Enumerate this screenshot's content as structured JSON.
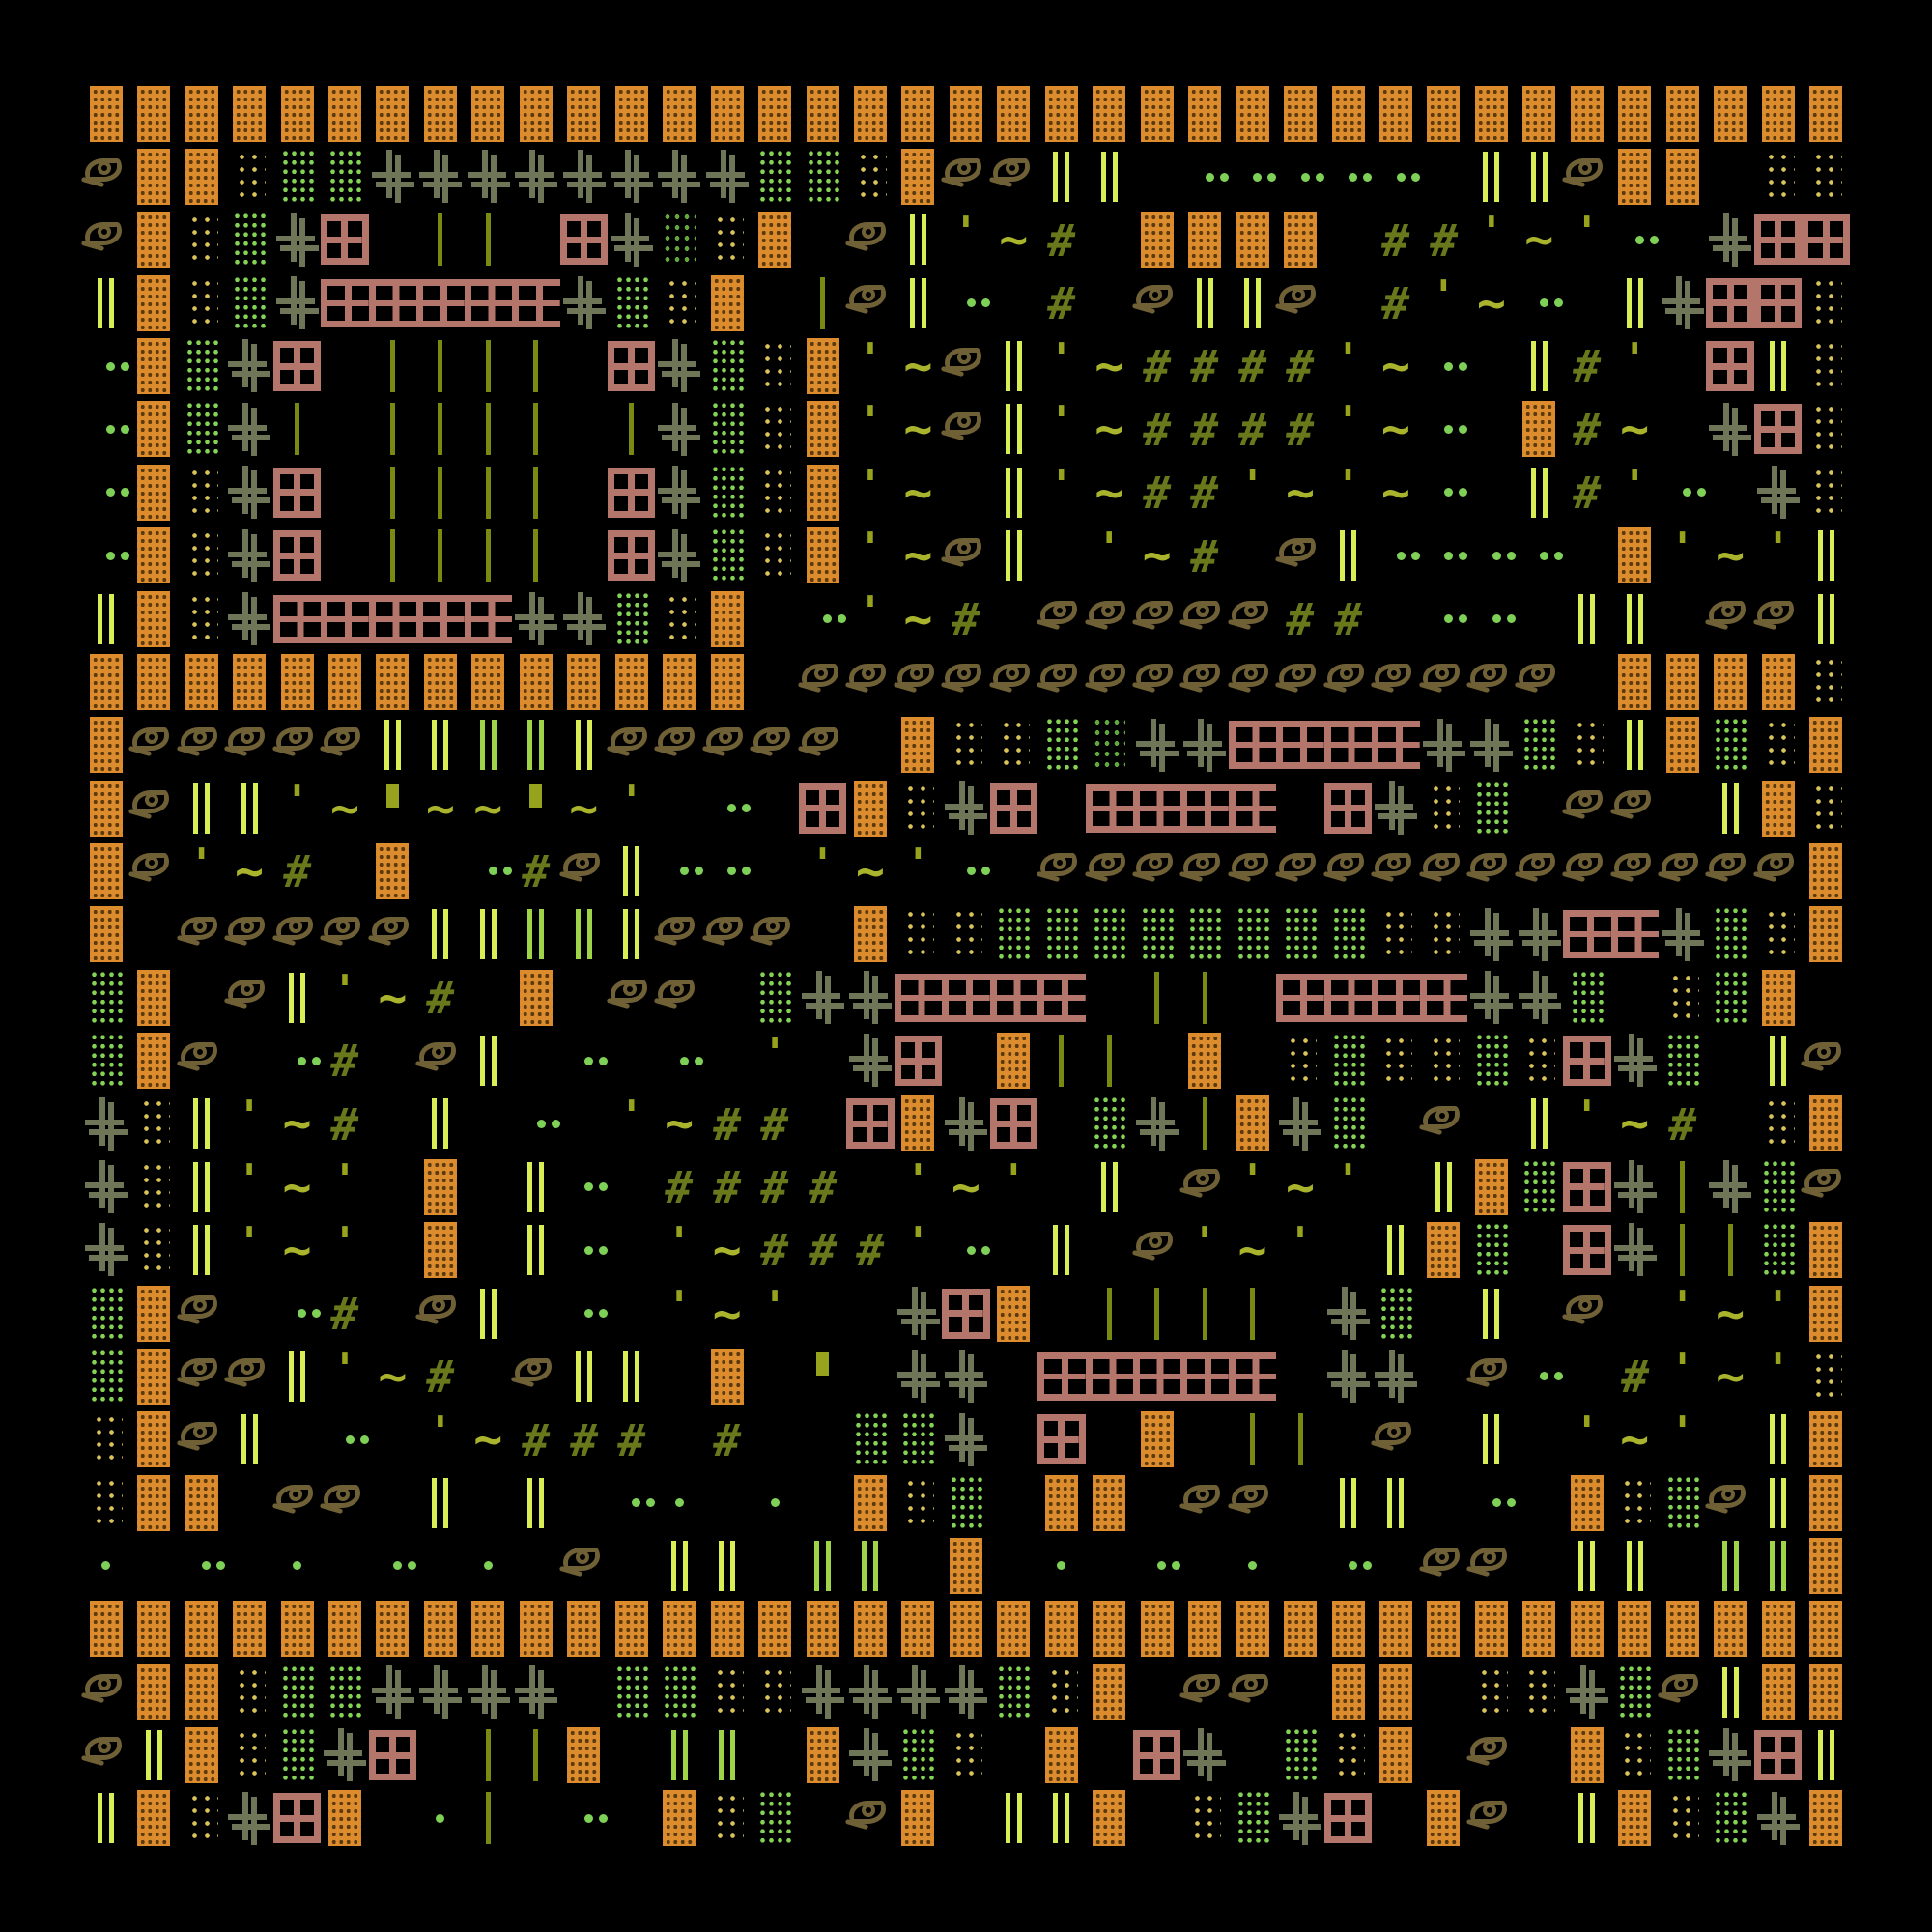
{
  "artwork_type": "textmode-glyph-mosaic",
  "palette": {
    "bg": "#000000",
    "orange": "#DC8B2D",
    "orangehole": "#5C3A0E",
    "salmon": "#B4756A",
    "green": "#85D355",
    "greendark": "#63A83F",
    "yellow": "#D9C257",
    "cross": "#6F7557",
    "chart": "#D9EE55",
    "midgreen": "#9FD348",
    "olive": "#7A8A10",
    "olive2": "#97A31C",
    "tilde": "#A9B42C",
    "hash": "#69781B",
    "eye": "#6F6036",
    "dotg": "#7FD057"
  },
  "grid": {
    "cols": 37,
    "rows": 28,
    "cell_w": 49.46,
    "cell_h": 65.36,
    "legend": {
      "O": "orange",
      "W": "pane",
      "S": "strip",
      "G": "green",
      "d": "greendark",
      "g": "greendark",
      "y": "yellow",
      "E": "eye",
      "+": "cross",
      "|": "barbright",
      "l": "bargreen",
      "i": "stem",
      "#": "hash",
      "~": "tilde",
      "'": "tick",
      "q": "quote",
      ".": "dots2",
      ",": "dot1",
      " ": "empty"
    },
    "glyphs": {
      "orange": {
        "name": "orange-dot-block"
      },
      "pane": {
        "name": "window-pane-icon"
      },
      "strip": {
        "name": "pane-strip-segment"
      },
      "green": {
        "name": "green-dot-block"
      },
      "greendark": {
        "name": "dark-green-dot-block"
      },
      "yellow": {
        "name": "yellow-dot-block"
      },
      "eye": {
        "name": "eye-icon",
        "parts": [
          "p-lid",
          "p-iris",
          "p-tail"
        ]
      },
      "cross": {
        "name": "double-cross-glyph"
      },
      "barbright": {
        "name": "double-bar-bright"
      },
      "bargreen": {
        "name": "double-bar-green"
      },
      "stem": {
        "name": "stem-bar"
      },
      "hash": {
        "name": "hash-glyph",
        "text": "#"
      },
      "tilde": {
        "name": "tilde-glyph",
        "text": "~"
      },
      "tick": {
        "name": "tick-glyph",
        "text": "'"
      },
      "quote": {
        "name": "quote-block"
      },
      "dots2": {
        "name": "dot-pair"
      },
      "dot1": {
        "name": "dot"
      },
      "empty": {
        "name": "empty-cell"
      }
    },
    "rows_data": [
      "OOOOOOOOOOOOOOOOOOOOOOOOOOOOOOOOOOOOO",
      "EOOyGG++++++++GGyOEE|| ..... ||EOO yy",
      "EOyG+W ii W+gyO E|'~# OOOO ##'~'. +WW",
      "|OyG+SSSSS+GyO iE|. # E||E #'~. |+WWy",
      ".OG+W iiii W+GyO'~E|'~####'~. |#' W|y",
      ".OG+i iiii i+GyO'~E|'~####'~. O#~ +Wy",
      ".Oy+W iiii W+GyO'~ |'~##'~'~. |#'. +y",
      ".Oy+W iiii W+GyO'~E| '~# E|.... O'~'|",
      "|Oy+SSSSS++GyO .'~# EEEEE## .. || EE|",
      "OOOOOOOOOOOOOO EEEEEEEEEEEEEEEE OOOOy",
      "OEEEEE||ll|EEEEE OyyGd++SSSS++Gy|OGyO",
      "OE||'~q~~q~' . WOy+W SSSS W+yG EE |Oy",
      "OE'~# O .#E|.. '~'. EEEEEEEEEEEEEEEEO",
      "O EEEEE||ll|EEE OyyGGGGGGGGyy++SS+GyO",
      "GO E|'~# O EE G++SSSS ii SSSS++G yGO",
      "GOE .# E| . . ' +W Oii O yGyyGyW+G |EO",
      "+y|'~# | . '~## WO+W G+iO+G E |'~# yO",
      "+y|'~' O |. #### '~' | E'~' |OGW+i+GE",
      "+y|'~' O |. '~###'. | E'~' |OG W+iiGO",
      "GOE .# E| . '~'  +WO iiii +G | E '~'O",
      "GOEE|'~# E|| O q ++ SSSSS ++ E. #'~'y",
      "yOE| . '~### #  GG+ W O ii E | '~' |O",
      "yOO EE | | ., , OyG OO EE || . OyGE|O",
      ", . , . , E || ll O , . , . EE || llO",
      "OOOOOOOOOOOOOOOOOOOOOOOOOOOOOOOOOOOOO",
      "EOOyGG++++ GGyy++++GyO EE OO yy+GE|OO",
      "E|OyG+W iiO ll O+Gy O W+ GyO E OyG+W|",
      "|Oy+WO ,i . OyG EO ||O yG+W OE |OyG+O"
    ]
  }
}
